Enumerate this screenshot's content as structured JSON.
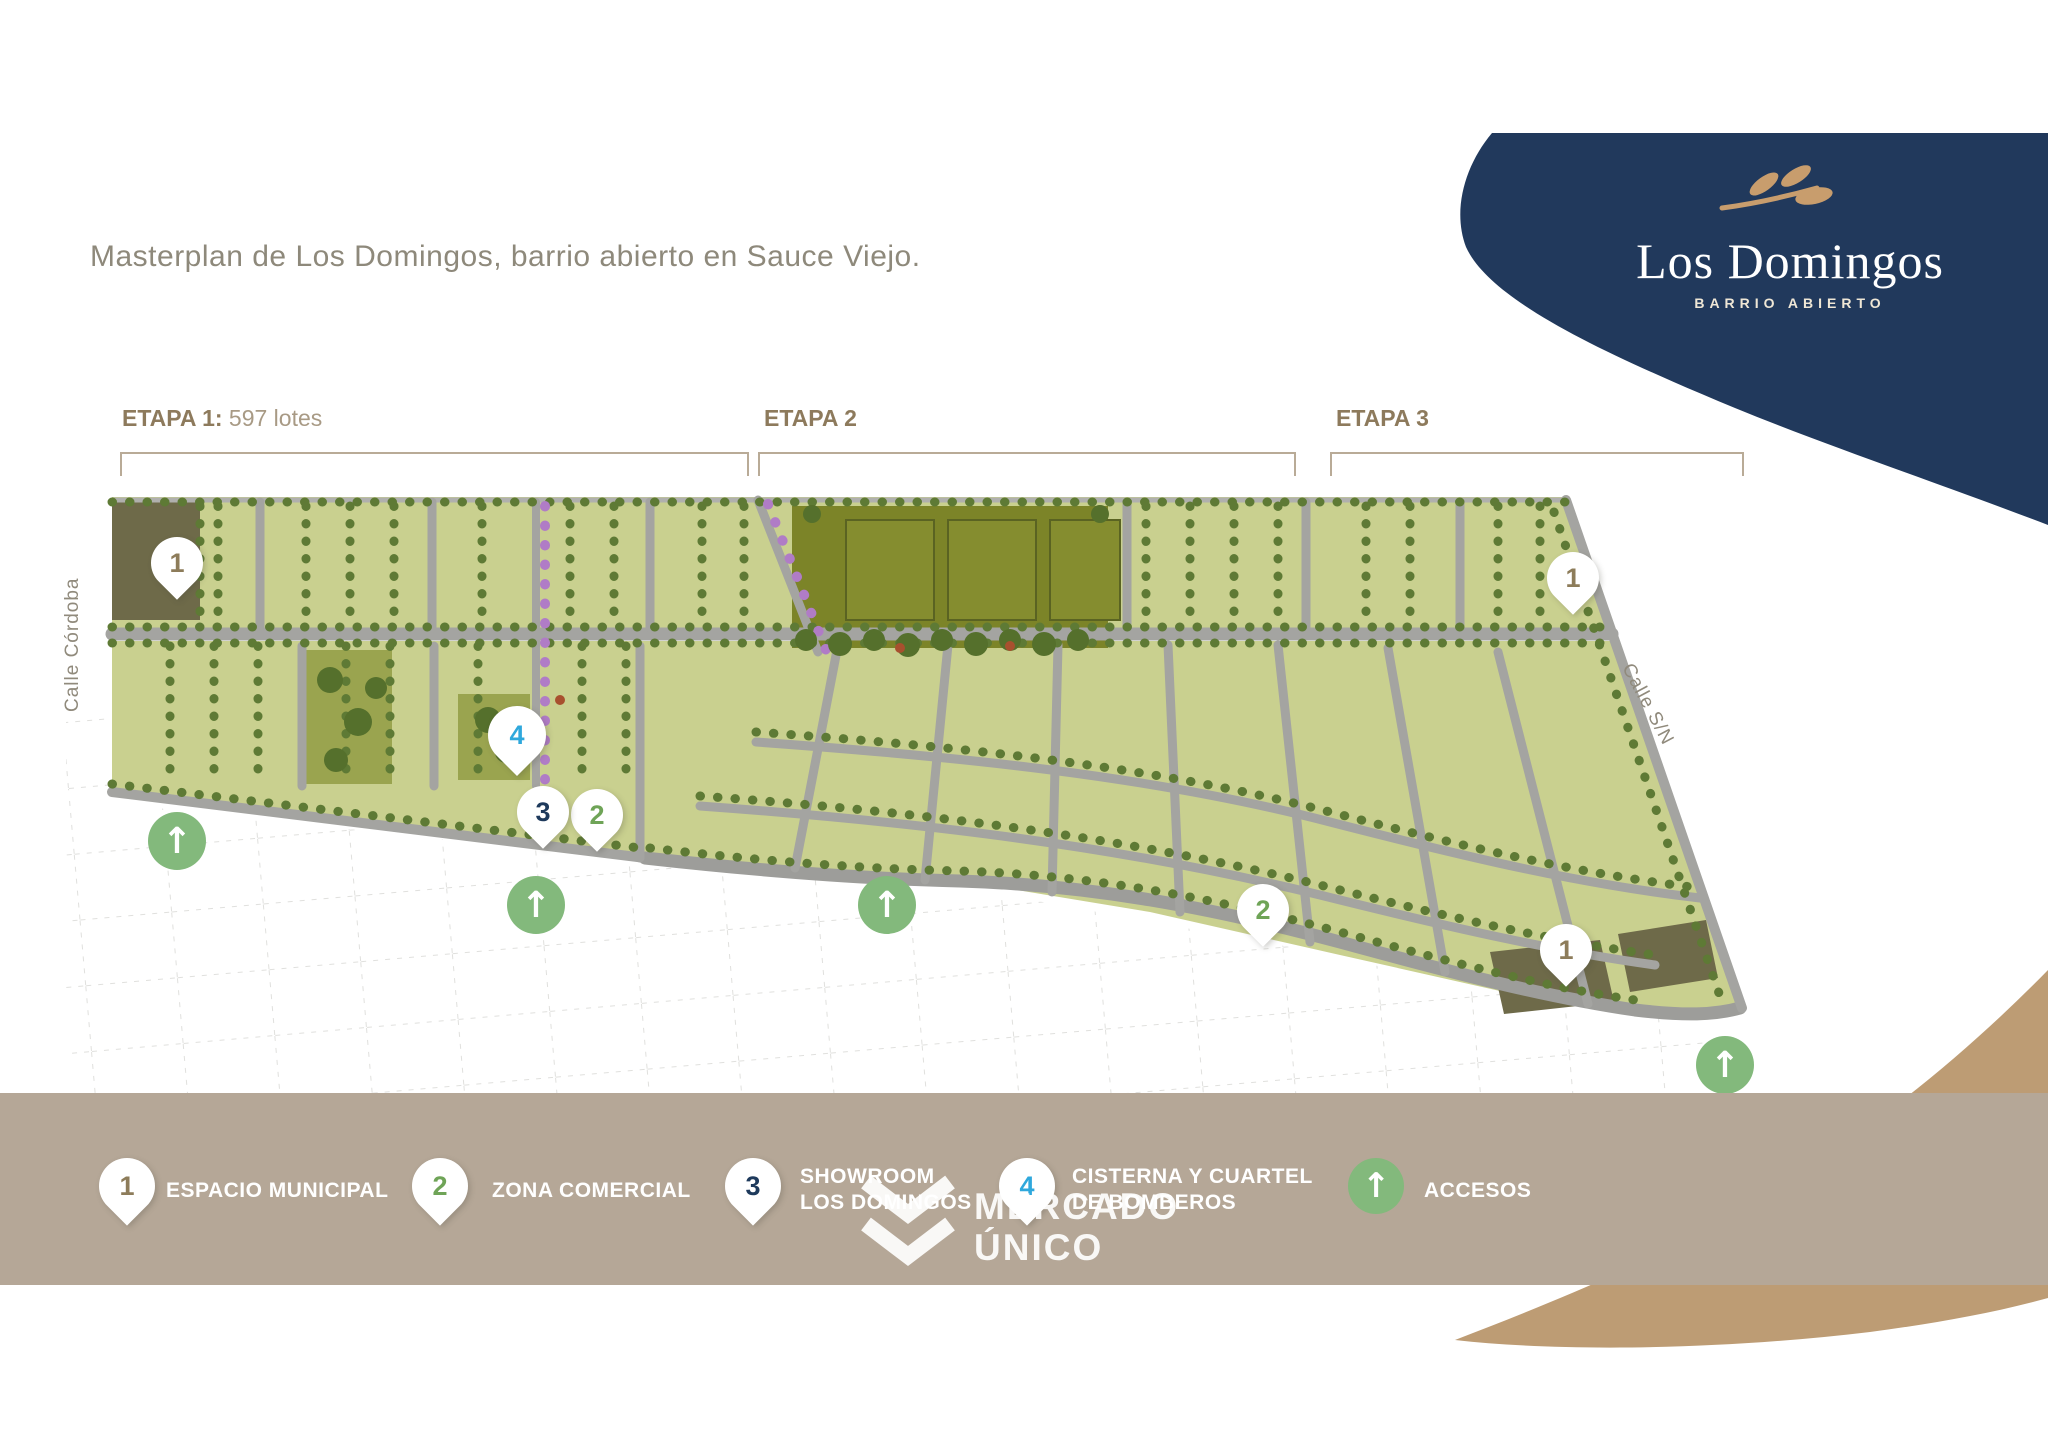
{
  "page": {
    "title_text": "Masterplan de Los Domingos, barrio abierto en Sauce Viejo."
  },
  "logo": {
    "name": "Los Domingos",
    "subtitle": "BARRIO ABIERTO"
  },
  "stages": {
    "stage1_label": "ETAPA 1:",
    "stage1_detail": "597 lotes",
    "stage2_label": "ETAPA 2",
    "stage3_label": "ETAPA 3"
  },
  "streets": {
    "left_street": "Calle Córdoba",
    "right_street": "Calle S/N"
  },
  "markers": {
    "pin1": "1",
    "pin2": "2",
    "pin3": "3",
    "pin4": "4",
    "access_arrow": "↑"
  },
  "legend": {
    "item1": {
      "number": "1",
      "label": "ESPACIO MUNICIPAL"
    },
    "item2": {
      "number": "2",
      "label": "ZONA COMERCIAL"
    },
    "item3": {
      "number": "3",
      "label": "SHOWROOM\nLOS DOMINGOS"
    },
    "item4": {
      "number": "4",
      "label": "CISTERNA Y CUARTEL\nDE BOMBEROS"
    },
    "item5": {
      "symbol": "↑",
      "label": "ACCESOS"
    }
  },
  "watermark": {
    "brand": "MERCADO\nÚNICO"
  },
  "colors": {
    "navy": "#21395c",
    "leaf_tan": "#c89d6d",
    "legend_bar": "#b5a797",
    "corner_blob": "#bd9c74",
    "lot_green": "#c9d08f",
    "park_olive": "#7c8428",
    "tree_green": "#5e7a35",
    "road_gray": "#a4a4a1",
    "dark_lot": "#6e6a49",
    "pin1_color": "#8d7c5a",
    "pin2_color": "#6fa457",
    "pin3_color": "#1e3a5c",
    "pin4_color": "#2fa8dc",
    "access_green": "#83b97c",
    "purple_tree": "#b07cc6"
  }
}
